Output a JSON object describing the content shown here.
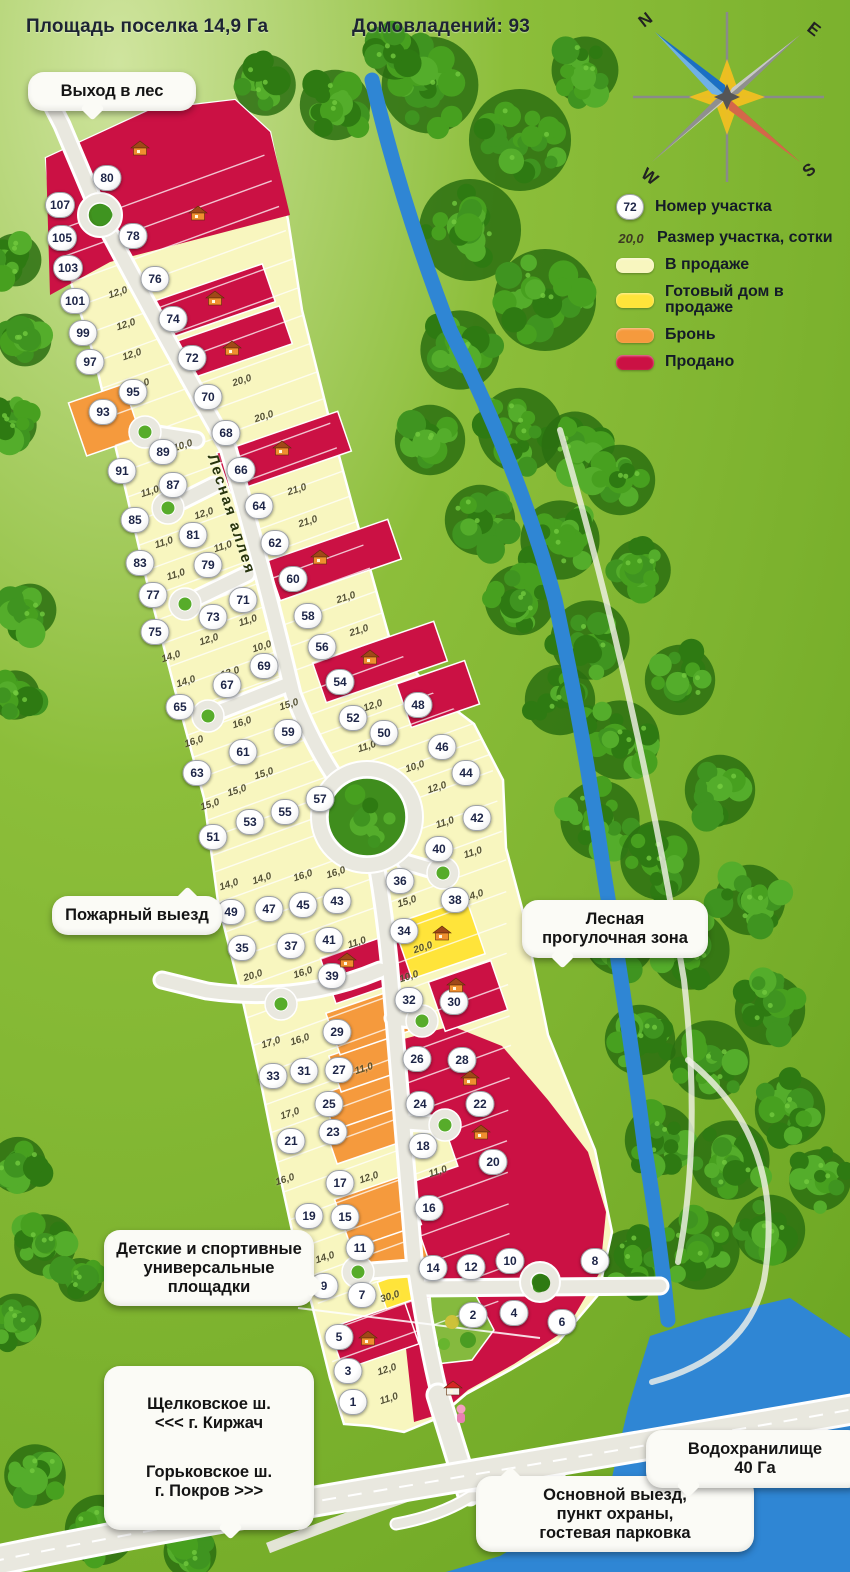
{
  "header": {
    "area": "Площадь поселка 14,9 Га",
    "households": "Домовладений: 93"
  },
  "compass": {
    "n": "N",
    "e": "E",
    "s": "S",
    "w": "W"
  },
  "legend": {
    "number_badge": "72",
    "number_label": "Номер участка",
    "size_sample": "20,0",
    "size_label": "Размер участка, сотки",
    "items": [
      {
        "key": "sale",
        "label": "В продаже",
        "color": "#f8f6bf"
      },
      {
        "key": "ready",
        "label": "Готовый дом в продаже",
        "color": "#ffe43a"
      },
      {
        "key": "reserved",
        "label": "Бронь",
        "color": "#f59a3d"
      },
      {
        "key": "sold",
        "label": "Продано",
        "color": "#cb1144"
      }
    ]
  },
  "street_name": "Лесная аллея",
  "callouts": {
    "forest_exit": "Выход в лес",
    "fire_exit": "Пожарный выезд",
    "walk_zone": "Лесная прогулочная зона",
    "playgrounds": "Детские и спортивные универсальные площадки",
    "highway_1": "Щелковское ш.\n<<< г. Киржач",
    "highway_2": "Горьковское ш.\nг. Покров >>>",
    "main_exit": "Основной выезд,\nпункт охраны,\nгостевая парковка",
    "reservoir": "Водохранилище\n40 Га"
  },
  "plots": [
    [
      "107",
      60,
      205,
      "sold"
    ],
    [
      "105",
      62,
      238,
      "sold"
    ],
    [
      "103",
      68,
      268,
      "sold"
    ],
    [
      "101",
      75,
      301,
      "sale"
    ],
    [
      "99",
      83,
      333,
      "sale"
    ],
    [
      "97",
      90,
      362,
      "sale"
    ],
    [
      "95",
      133,
      392,
      "sale"
    ],
    [
      "93",
      103,
      412,
      "reserved"
    ],
    [
      "91",
      122,
      471,
      "sale"
    ],
    [
      "89",
      163,
      452,
      "sale"
    ],
    [
      "87",
      173,
      485,
      "sale"
    ],
    [
      "85",
      135,
      520,
      "sale"
    ],
    [
      "83",
      140,
      563,
      "sale"
    ],
    [
      "81",
      193,
      535,
      "sale"
    ],
    [
      "79",
      208,
      565,
      "sale"
    ],
    [
      "77",
      153,
      595,
      "sale"
    ],
    [
      "75",
      155,
      632,
      "sale"
    ],
    [
      "73",
      213,
      617,
      "sale"
    ],
    [
      "71",
      243,
      600,
      "sale"
    ],
    [
      "69",
      264,
      666,
      "sale"
    ],
    [
      "67",
      227,
      685,
      "sale"
    ],
    [
      "65",
      180,
      707,
      "sale"
    ],
    [
      "63",
      197,
      773,
      "sale"
    ],
    [
      "61",
      243,
      752,
      "sale"
    ],
    [
      "59",
      288,
      732,
      "sale"
    ],
    [
      "57",
      320,
      799,
      "sale"
    ],
    [
      "55",
      285,
      812,
      "sale"
    ],
    [
      "53",
      250,
      822,
      "sale"
    ],
    [
      "51",
      213,
      837,
      "sale"
    ],
    [
      "49",
      231,
      912,
      "sale"
    ],
    [
      "47",
      269,
      909,
      "sale"
    ],
    [
      "45",
      303,
      905,
      "sale"
    ],
    [
      "43",
      337,
      901,
      "sale"
    ],
    [
      "41",
      329,
      940,
      "sale"
    ],
    [
      "39",
      332,
      976,
      "sold"
    ],
    [
      "37",
      291,
      946,
      "sale"
    ],
    [
      "35",
      242,
      948,
      "sale"
    ],
    [
      "33",
      273,
      1076,
      "sale"
    ],
    [
      "31",
      304,
      1071,
      "sale"
    ],
    [
      "29",
      337,
      1032,
      "reserved"
    ],
    [
      "27",
      339,
      1070,
      "reserved"
    ],
    [
      "25",
      329,
      1104,
      "reserved"
    ],
    [
      "23",
      333,
      1132,
      "reserved"
    ],
    [
      "21",
      291,
      1141,
      "sale"
    ],
    [
      "19",
      309,
      1216,
      "sale"
    ],
    [
      "17",
      340,
      1183,
      "sale"
    ],
    [
      "15",
      345,
      1217,
      "reserved"
    ],
    [
      "11",
      360,
      1248,
      "reserved"
    ],
    [
      "9",
      324,
      1286,
      "sale"
    ],
    [
      "7",
      362,
      1295,
      "sale"
    ],
    [
      "5",
      339,
      1337,
      "sold"
    ],
    [
      "3",
      348,
      1371,
      "sale"
    ],
    [
      "1",
      353,
      1402,
      "sale"
    ],
    [
      "80",
      107,
      178,
      "sold"
    ],
    [
      "78",
      133,
      236,
      "sold"
    ],
    [
      "76",
      155,
      279,
      "sale"
    ],
    [
      "74",
      173,
      319,
      "sold"
    ],
    [
      "72",
      192,
      358,
      "sold"
    ],
    [
      "70",
      208,
      397,
      "sale"
    ],
    [
      "68",
      226,
      433,
      "sale"
    ],
    [
      "66",
      241,
      470,
      "sold"
    ],
    [
      "64",
      259,
      506,
      "sale"
    ],
    [
      "62",
      275,
      543,
      "sale"
    ],
    [
      "60",
      293,
      579,
      "sold"
    ],
    [
      "58",
      308,
      616,
      "sale"
    ],
    [
      "56",
      322,
      647,
      "sale"
    ],
    [
      "54",
      340,
      682,
      "sold"
    ],
    [
      "52",
      353,
      718,
      "sale"
    ],
    [
      "50",
      384,
      733,
      "sale"
    ],
    [
      "48",
      418,
      705,
      "sold"
    ],
    [
      "46",
      442,
      747,
      "sale"
    ],
    [
      "44",
      466,
      773,
      "sale"
    ],
    [
      "42",
      477,
      818,
      "sale"
    ],
    [
      "40",
      439,
      849,
      "sale"
    ],
    [
      "38",
      455,
      900,
      "sale"
    ],
    [
      "36",
      400,
      881,
      "sale"
    ],
    [
      "34",
      404,
      931,
      "ready"
    ],
    [
      "32",
      409,
      1000,
      "sale"
    ],
    [
      "30",
      454,
      1002,
      "sold"
    ],
    [
      "28",
      462,
      1060,
      "sold"
    ],
    [
      "26",
      417,
      1059,
      "sold"
    ],
    [
      "24",
      420,
      1104,
      "sold"
    ],
    [
      "22",
      480,
      1104,
      "sold"
    ],
    [
      "20",
      493,
      1162,
      "sold"
    ],
    [
      "18",
      423,
      1146,
      "sale"
    ],
    [
      "16",
      429,
      1208,
      "sold"
    ],
    [
      "14",
      433,
      1268,
      "sold"
    ],
    [
      "12",
      471,
      1267,
      "sold"
    ],
    [
      "10",
      510,
      1261,
      "sold"
    ],
    [
      "8",
      595,
      1261,
      "sold"
    ],
    [
      "6",
      562,
      1322,
      "sold"
    ],
    [
      "4",
      514,
      1313,
      "sold"
    ],
    [
      "2",
      473,
      1315,
      "sold"
    ]
  ],
  "size_labels": [
    [
      "12,0",
      118,
      293
    ],
    [
      "12,0",
      126,
      325
    ],
    [
      "12,0",
      132,
      355
    ],
    [
      "15,0",
      140,
      385
    ],
    [
      "20,0",
      242,
      381
    ],
    [
      "20,0",
      264,
      417
    ],
    [
      "10,0",
      183,
      446
    ],
    [
      "12,0",
      204,
      514
    ],
    [
      "11,0",
      150,
      492
    ],
    [
      "11,0",
      164,
      543
    ],
    [
      "11,0",
      223,
      547
    ],
    [
      "11,0",
      176,
      575
    ],
    [
      "21,0",
      297,
      490
    ],
    [
      "21,0",
      308,
      522
    ],
    [
      "21,0",
      346,
      598
    ],
    [
      "21,0",
      359,
      631
    ],
    [
      "11,0",
      248,
      621
    ],
    [
      "12,0",
      209,
      640
    ],
    [
      "14,0",
      171,
      657
    ],
    [
      "10,0",
      262,
      647
    ],
    [
      "12,0",
      230,
      673
    ],
    [
      "14,0",
      186,
      682
    ],
    [
      "16,0",
      194,
      742
    ],
    [
      "16,0",
      242,
      723
    ],
    [
      "15,0",
      289,
      705
    ],
    [
      "12,0",
      373,
      706
    ],
    [
      "11,0",
      367,
      747
    ],
    [
      "10,0",
      415,
      767
    ],
    [
      "12,0",
      437,
      788
    ],
    [
      "15,0",
      264,
      774
    ],
    [
      "15,0",
      237,
      791
    ],
    [
      "15,0",
      210,
      805
    ],
    [
      "11,0",
      445,
      823
    ],
    [
      "11,0",
      473,
      853
    ],
    [
      "14,0",
      229,
      885
    ],
    [
      "14,0",
      262,
      879
    ],
    [
      "16,0",
      303,
      876
    ],
    [
      "16,0",
      336,
      873
    ],
    [
      "15,0",
      407,
      902
    ],
    [
      "14,0",
      474,
      896
    ],
    [
      "11,0",
      357,
      943
    ],
    [
      "20,0",
      423,
      948
    ],
    [
      "20,0",
      253,
      976
    ],
    [
      "16,0",
      303,
      973
    ],
    [
      "10,0",
      409,
      977
    ],
    [
      "17,0",
      271,
      1043
    ],
    [
      "16,0",
      300,
      1040
    ],
    [
      "11,0",
      364,
      1069
    ],
    [
      "17,0",
      290,
      1114
    ],
    [
      "16,0",
      285,
      1180
    ],
    [
      "12,0",
      369,
      1178
    ],
    [
      "11,0",
      438,
      1172
    ],
    [
      "14,0",
      325,
      1258
    ],
    [
      "30,0",
      390,
      1297
    ],
    [
      "12,0",
      387,
      1370
    ],
    [
      "11,0",
      389,
      1399
    ]
  ],
  "house_icons": [
    [
      140,
      148
    ],
    [
      198,
      213
    ],
    [
      215,
      298
    ],
    [
      232,
      348
    ],
    [
      282,
      448
    ],
    [
      320,
      557
    ],
    [
      370,
      657
    ],
    [
      347,
      960
    ],
    [
      442,
      933
    ],
    [
      456,
      985
    ],
    [
      470,
      1078
    ],
    [
      481,
      1132
    ],
    [
      368,
      1338
    ]
  ],
  "office_icon": [
    453,
    1388
  ]
}
